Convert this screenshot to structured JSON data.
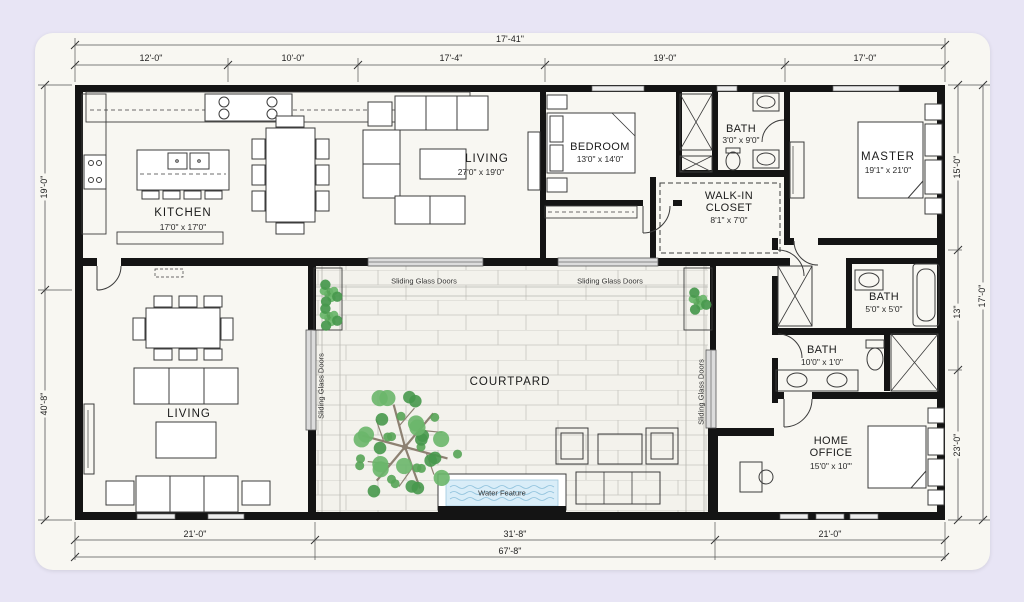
{
  "rooms": {
    "kitchen": {
      "name": "KITCHEN",
      "dims": "17'0\" x 17'0\""
    },
    "living_top": {
      "name": "LIVING",
      "dims": "27'0\" x 19'0\""
    },
    "bedroom": {
      "name": "BEDROOM",
      "dims": "13'0\" x 14'0\""
    },
    "bath_top": {
      "name": "BATH",
      "dims": "3'0\" x 9'0\""
    },
    "walk_in_closet": {
      "line1": "WALK-IN",
      "line2": "CLOSET",
      "dims": "8'1\" x 7'0\""
    },
    "master": {
      "name": "MASTER",
      "dims": "19'1\" x 21'0\""
    },
    "bath_mid": {
      "name": "BATH",
      "dims": "5'0\" x 5'0\""
    },
    "bath_lower": {
      "name": "BATH",
      "dims": "10'0\" x 1'0\""
    },
    "home_office": {
      "line1": "HOME",
      "line2": "OFFICE",
      "dims": "15'0\" x 10'\""
    },
    "living_bottom": {
      "name": "LIVING"
    },
    "courtyard": {
      "name": "COURTPARD"
    },
    "water_feature": {
      "name": "Water Feature"
    }
  },
  "doors": {
    "sliding_label": "Sliding Glass Doors"
  },
  "dimensions": {
    "top_overall": "17'-41\"",
    "top_segments": [
      "12'-0\"",
      "10'-0\"",
      "17'-4\"",
      "19'-0\"",
      "17'-0\""
    ],
    "bottom_segments": [
      "21'-0\"",
      "31'-8\"",
      "21'-0\""
    ],
    "bottom_overall": "67'-8\"",
    "left_segments": [
      "19'-0\"",
      "40'-8\""
    ],
    "right_segments": [
      "15'-0\"",
      "13\"",
      "23'-0\""
    ],
    "right_overall": "17'-0\""
  },
  "colors": {
    "page_background": "#e8e5f5",
    "card_background": "#f8f7f2",
    "wall": "#141414",
    "tree_green": "#57a457",
    "water_blue": "#d9edf8"
  }
}
